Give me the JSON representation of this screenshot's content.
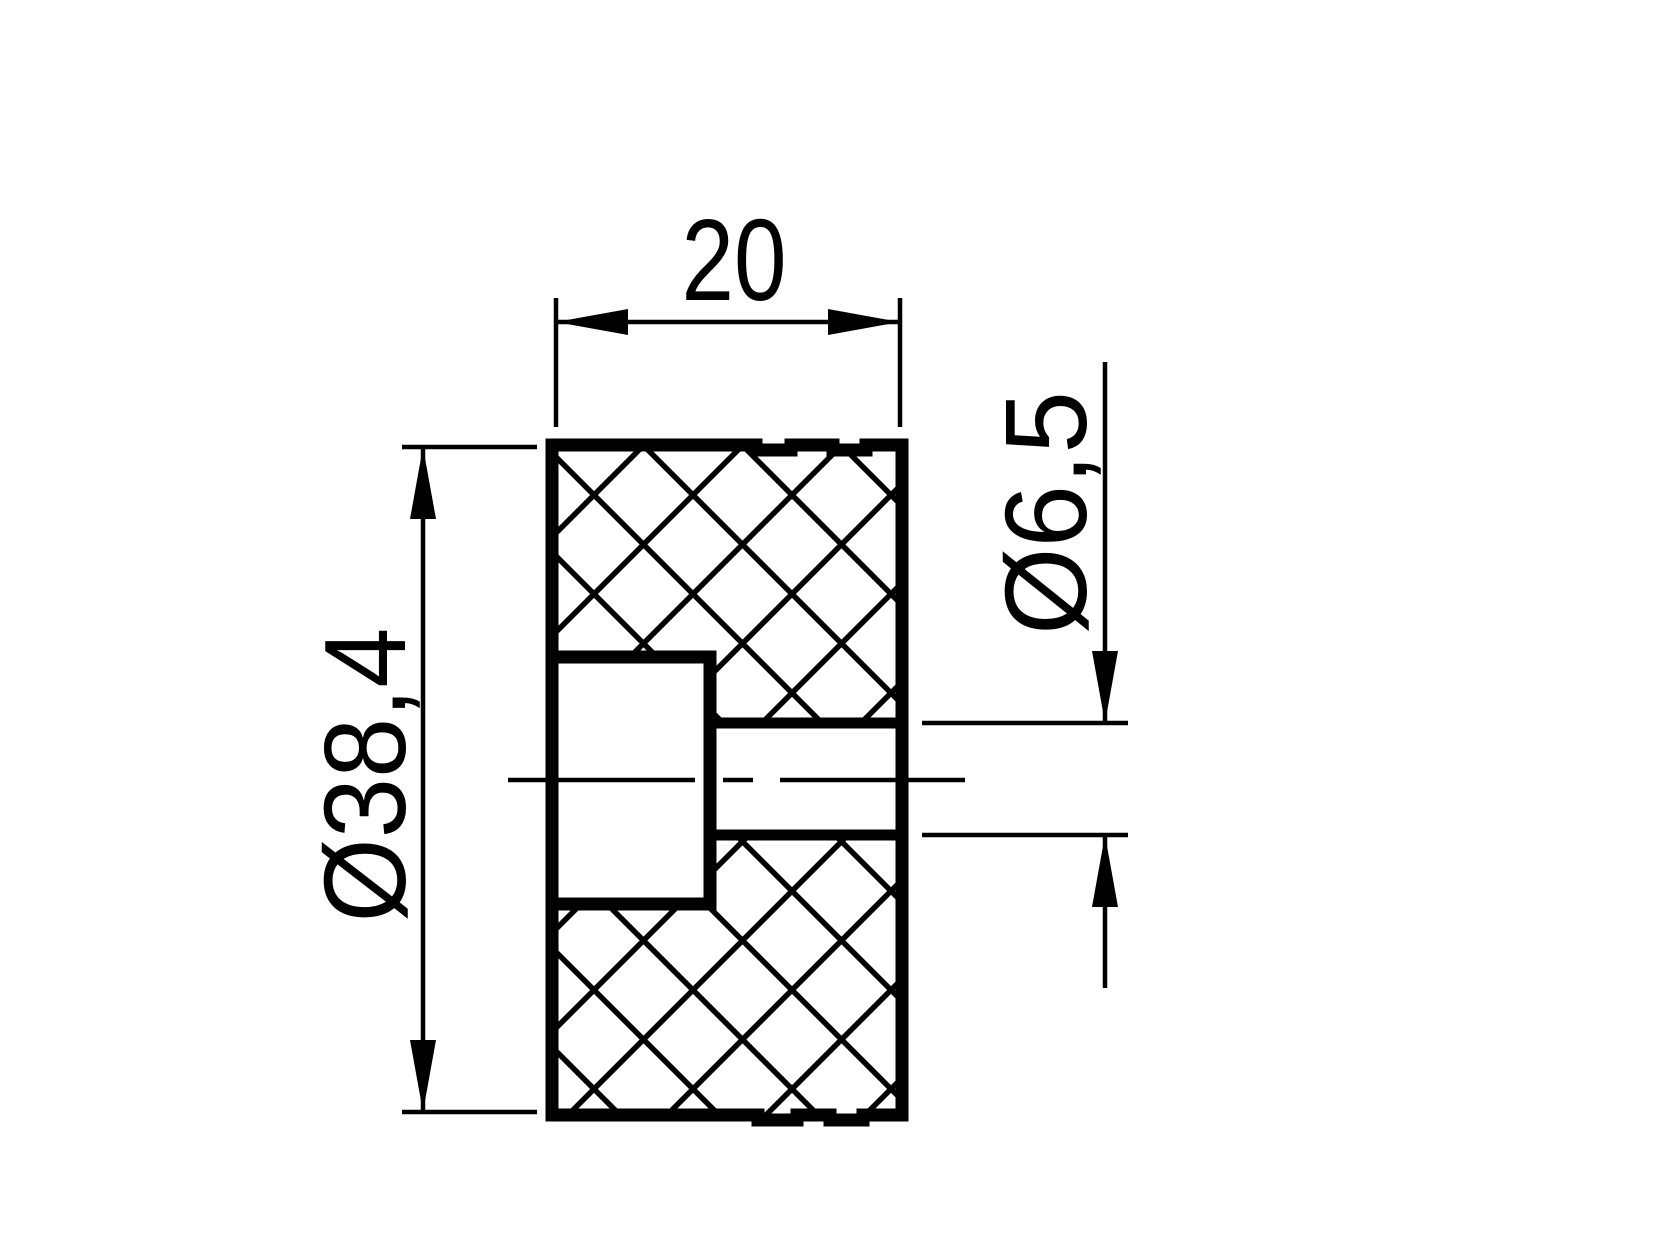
{
  "drawing": {
    "view_name": "section-view",
    "part": "cylindrical knurled spacer with counterbored through hole",
    "colors": {
      "line": "#000000",
      "background": "#ffffff"
    },
    "dimensions": [
      {
        "id": "width",
        "value": "20",
        "orientation": "horizontal"
      },
      {
        "id": "outer-diameter",
        "value": "Ø38,4",
        "orientation": "vertical"
      },
      {
        "id": "bore-diameter",
        "value": "Ø6,5",
        "orientation": "vertical"
      }
    ]
  }
}
